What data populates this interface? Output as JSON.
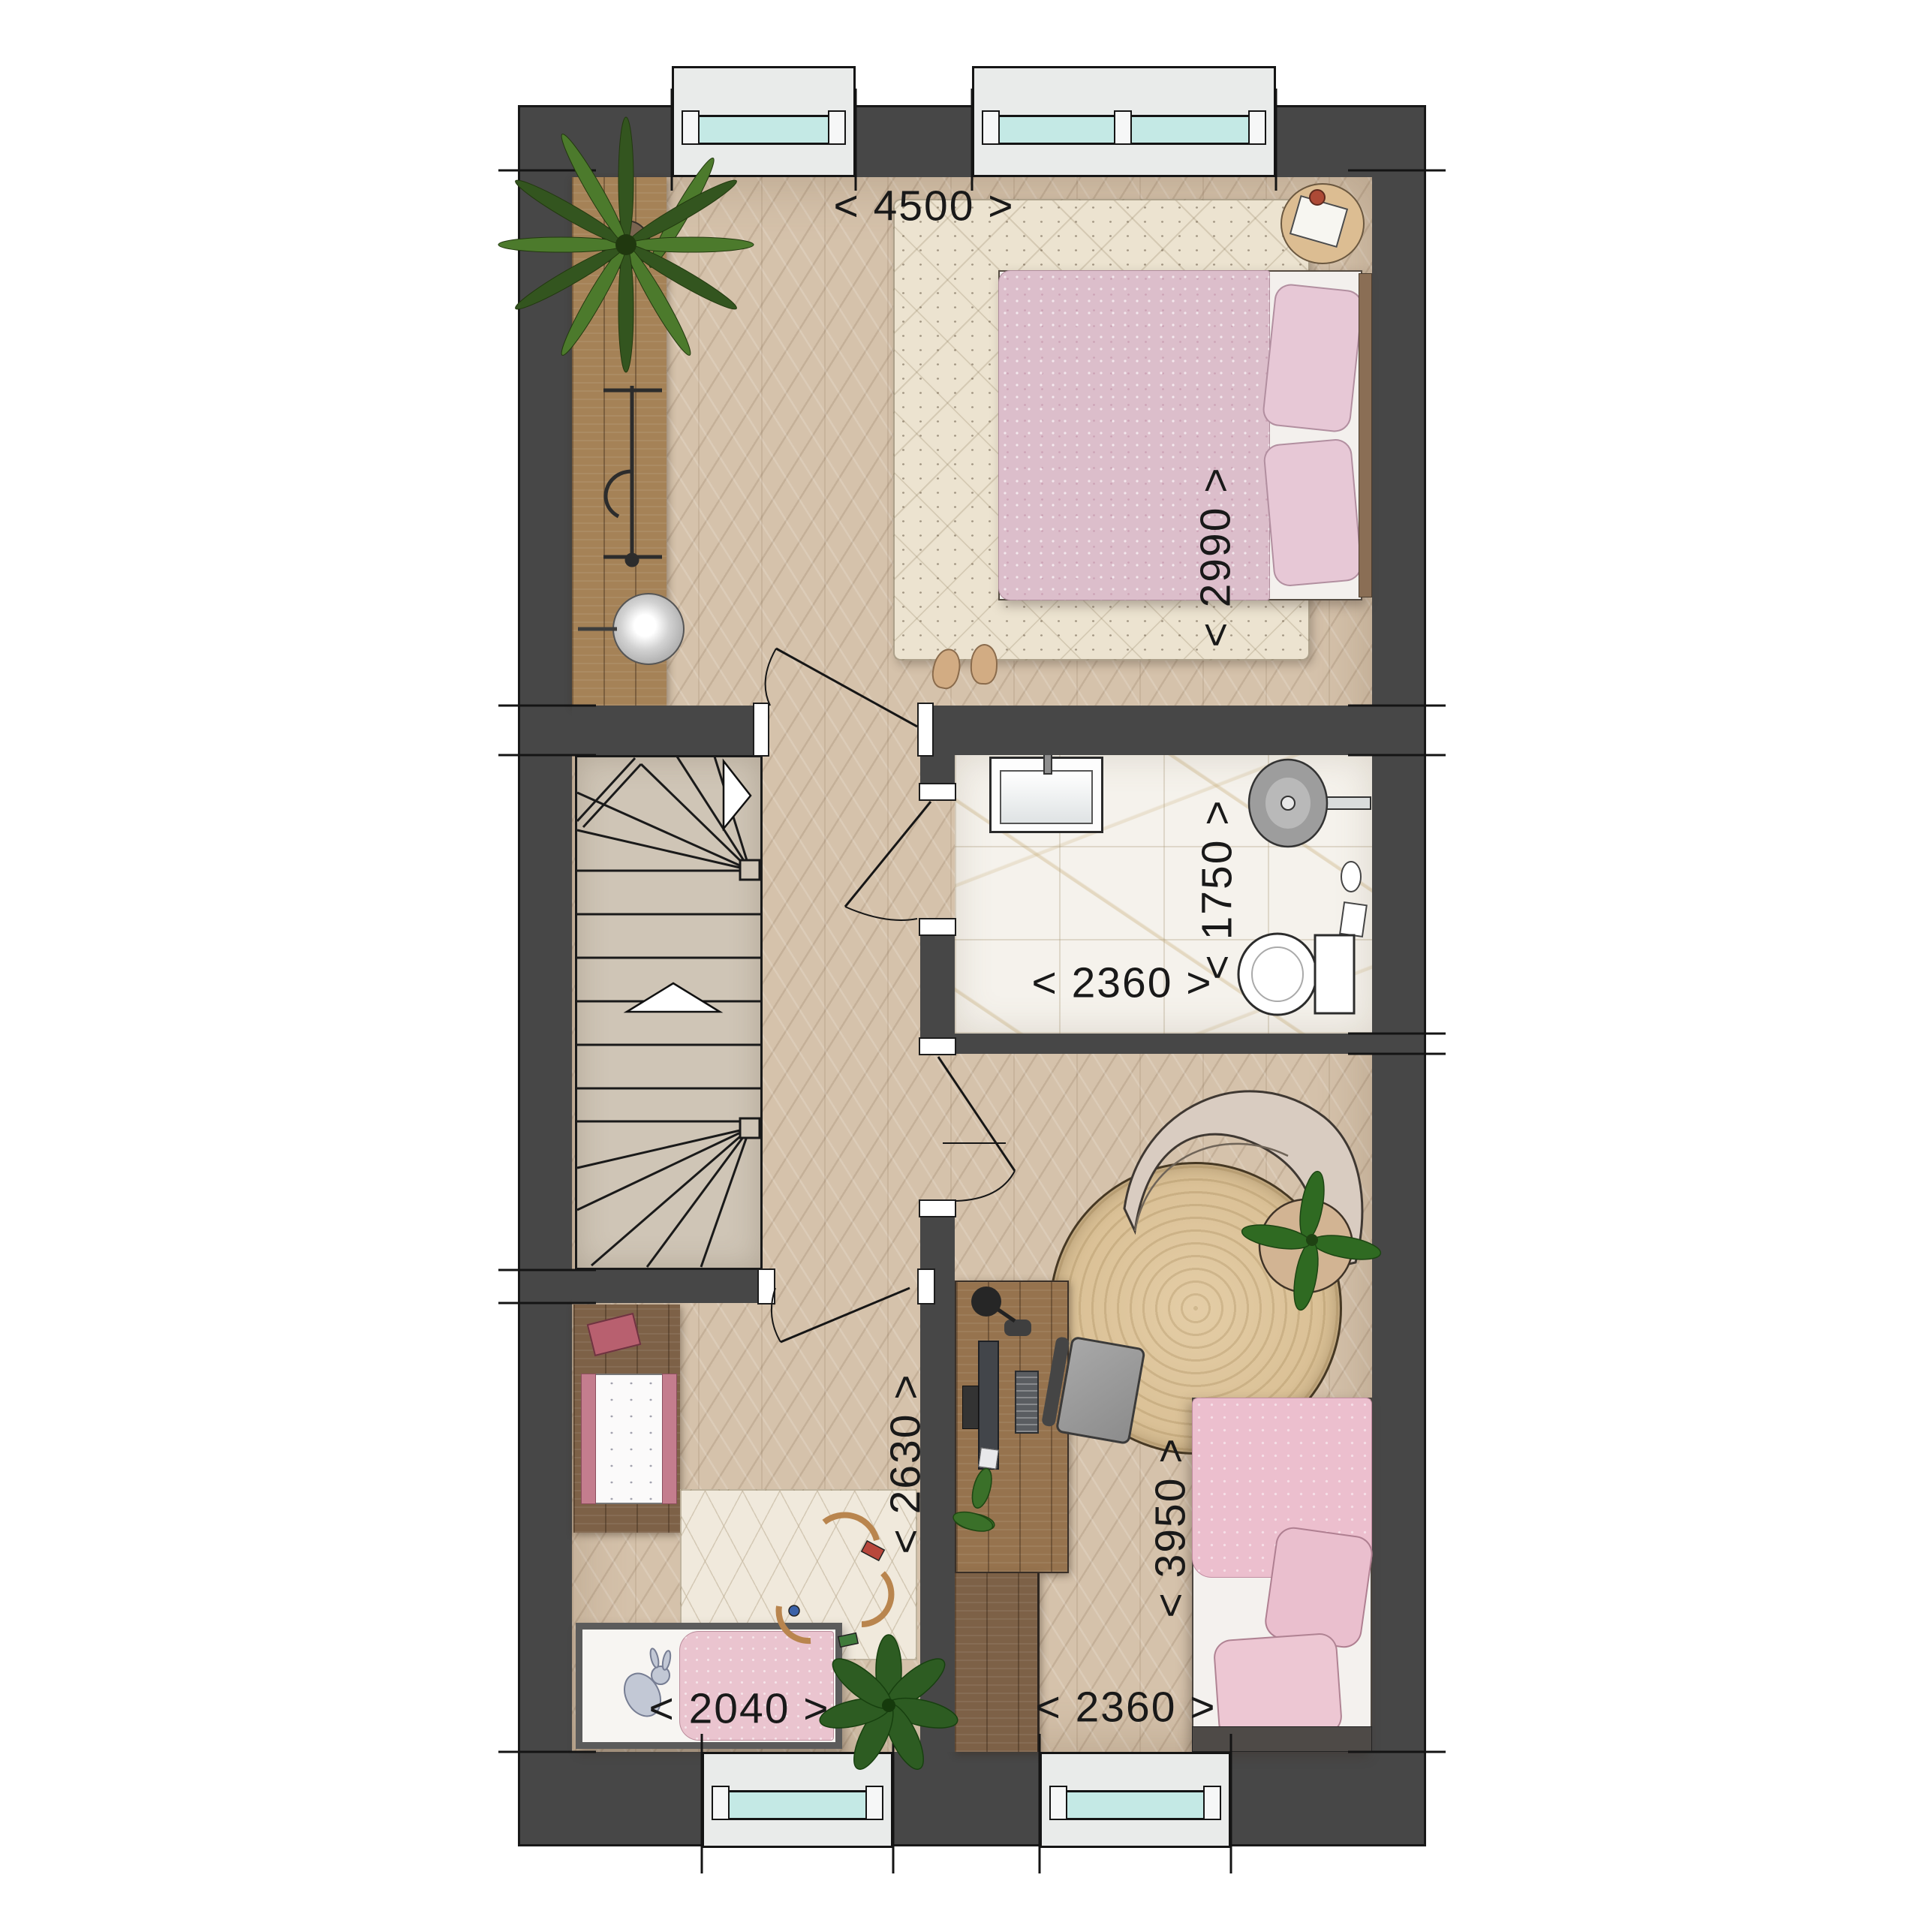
{
  "dims": {
    "master_width": "< 4500 >",
    "master_depth": "< 2990 >",
    "bath_depth": "< 1750 >",
    "bath_width": "< 2360 >",
    "hall_depth": "< 2630 >",
    "bedroom3_depth": "< 3950 >",
    "child_width": "< 2040 >",
    "bedroom3_width": "< 2360 >"
  },
  "palette": {
    "wall": "#474747",
    "parquet": "#d5c2ab",
    "stairs": "#cfc5b6",
    "marble": "#f5f2ec",
    "window_glass": "#c4e9e5",
    "window_recess": "#e9ebea",
    "pink_bedding": "#e0bccb",
    "wood_dark": "#7d6147",
    "wood_mid": "#a58257",
    "rug_cream": "#ece3d0",
    "rug_jute": "#ddc49c",
    "plant_green": "#2d5c22"
  },
  "furniture": [
    "double-bed",
    "bedside-table",
    "area-rug",
    "wardrobe",
    "fern-plant",
    "clothes-rack",
    "floor-lamp",
    "winder-staircase",
    "washbasin",
    "shower",
    "toilet",
    "curved-lounge-chair",
    "round-jute-rug",
    "desk",
    "monitor",
    "keyboard",
    "desk-lamp",
    "office-chair",
    "plant-side-table",
    "single-bed",
    "dresser-changing-table",
    "toy-train-track",
    "teddy",
    "pot-plant"
  ]
}
